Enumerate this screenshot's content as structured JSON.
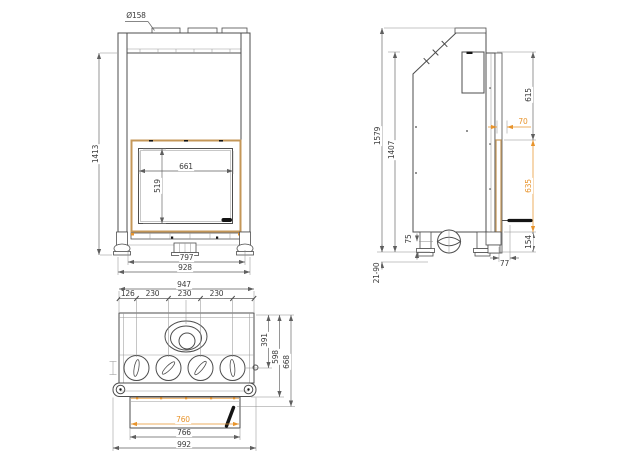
{
  "colors": {
    "accent_orange": "#E8942C",
    "frame_tan": "#C49758",
    "line_gray": "#4d4d4d",
    "background": "#ffffff"
  },
  "views": {
    "front": {
      "flue_diameter": "Ø158",
      "overall_height": "1413",
      "glass_width": "661",
      "glass_height": "519",
      "base_width": "797",
      "overall_width": "928"
    },
    "side": {
      "overall_height": "1579",
      "body_height": "1407",
      "upper_section_height": "615",
      "frame_depth": "70",
      "glass_section_height": "635",
      "base_section_height": "154",
      "foot_height": "75",
      "leveling_range": "21-90",
      "base_offset": "77"
    },
    "top": {
      "body_width": "947",
      "outlet_offset": "126",
      "outlet_pitch_1": "230",
      "outlet_pitch_2": "230",
      "outlet_pitch_3": "230",
      "flue_center_depth": "391",
      "body_depth": "598",
      "overall_depth": "668",
      "glass_opening_width": "760",
      "door_width": "766",
      "frame_width": "992"
    }
  }
}
